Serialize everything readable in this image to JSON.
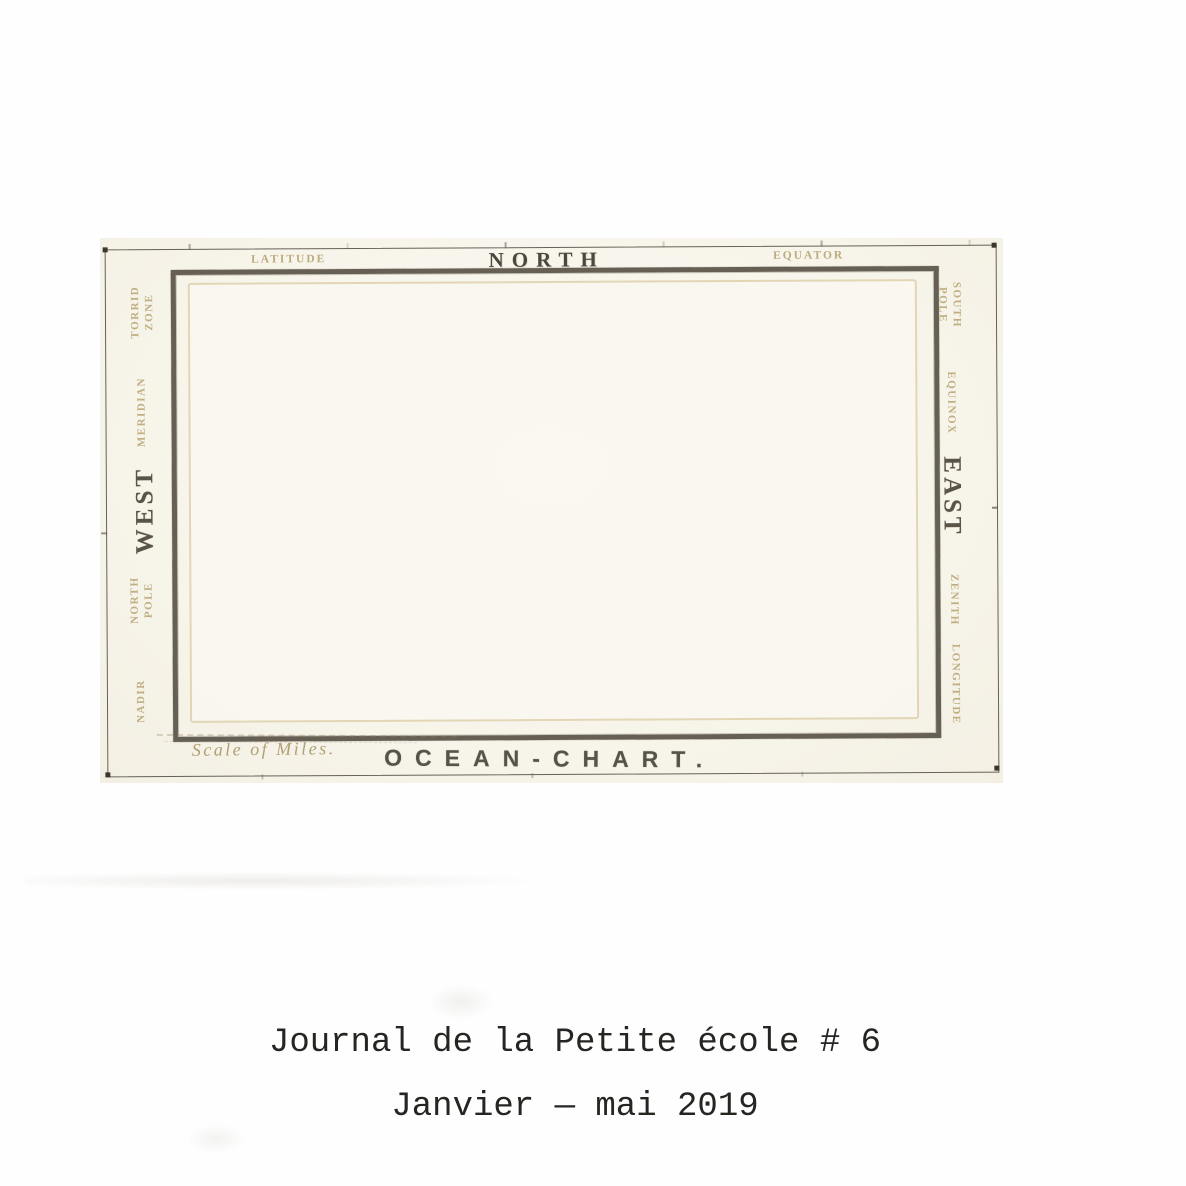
{
  "scan": {
    "map": {
      "title": "OCEAN-CHART.",
      "scale_label": "Scale of Miles.",
      "top_labels": [
        "LATITUDE",
        "NORTH",
        "EQUATOR"
      ],
      "left_labels": [
        "TORRID ZONE",
        "MERIDIAN",
        "WEST",
        "NORTH POLE",
        "NADIR"
      ],
      "right_labels": [
        "SOUTH POLE",
        "EQUINOX",
        "EAST",
        "ZENITH",
        "LONGITUDE"
      ]
    },
    "colors": {
      "paper": "#f7f4ea",
      "frame_rule": "#665f54",
      "inner_rule": "#ddcfa9",
      "engraved_dark": "#4b473f",
      "engraved_faint": "#c0ae81",
      "caption_ink": "#262522"
    }
  },
  "caption": {
    "line1": "Journal de la Petite école # 6",
    "line2": "Janvier — mai 2019"
  }
}
